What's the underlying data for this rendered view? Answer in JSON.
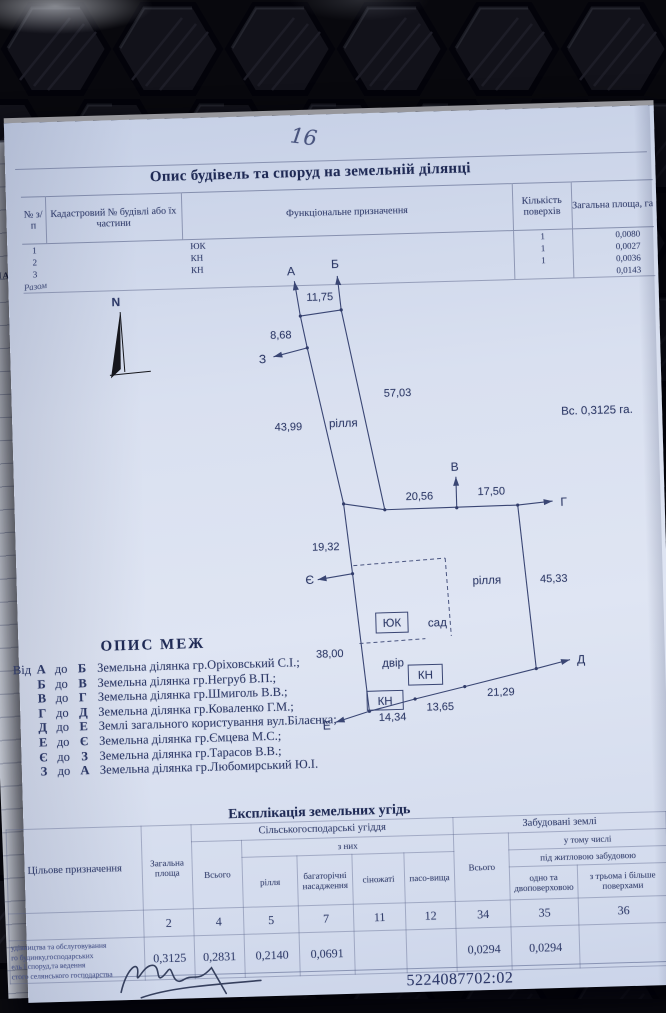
{
  "colors": {
    "page_bg": "#dbe2f1",
    "ink": "#2e3a68",
    "mat": "#0b0b10"
  },
  "photo": {
    "page_number": "16",
    "underpage_text": "ЗНА",
    "underpage_mark": "г"
  },
  "table1": {
    "title": "Опис будівель та споруд на земельній ділянці",
    "headers": {
      "num": "№ з/п",
      "cadastral": "Кадастровий № будівлі або їх частини",
      "function": "Функціональне призначення",
      "floors": "Кількість поверхів",
      "area": "Загальна площа, га"
    },
    "rows": [
      {
        "num": "1",
        "code": "ЮК",
        "floors": "1",
        "area": "0,0080"
      },
      {
        "num": "2",
        "code": "КН",
        "floors": "1",
        "area": "0,0027"
      },
      {
        "num": "3",
        "code": "КН",
        "floors": "1",
        "area": "0,0036"
      },
      {
        "num": "Разом",
        "code": "",
        "floors": "",
        "area": "0,0143"
      }
    ]
  },
  "diagram": {
    "north": "N",
    "area_note": "Вс. 0,3125 га.",
    "pt_a": "А",
    "pt_b": "Б",
    "pt_v": "В",
    "pt_g": "Г",
    "pt_d": "Д",
    "pt_e": "Е",
    "pt_ye": "Є",
    "pt_z": "З",
    "len_ab": "11,75",
    "len_az": "8,68",
    "len_left_slant": "43,99",
    "len_right_slant": "57,03",
    "len_vg1": "20,56",
    "len_vg2": "17,50",
    "len_right_vert": "45,33",
    "len_upper_left_vert": "19,32",
    "len_lower_left_vert": "38,00",
    "len_bottom1": "14,34",
    "len_bottom2": "13,65",
    "len_bottom3": "21,29",
    "land1": "рілля",
    "land2": "рілля",
    "sad": "сад",
    "dvir": "двір",
    "bld_yuk": "ЮК",
    "bld_kn1": "КН",
    "bld_kn2": "КН"
  },
  "borders": {
    "title": "ОПИС МЕЖ",
    "prefix": "Від",
    "connector": "до",
    "rows": [
      {
        "from": "А",
        "to": "Б",
        "text": "Земельна ділянка гр.Оріховський С.І.;"
      },
      {
        "from": "Б",
        "to": "В",
        "text": "Земельна ділянка гр.Негруб В.П.;"
      },
      {
        "from": "В",
        "to": "Г",
        "text": "Земельна ділянка гр.Шмиголь В.В.;"
      },
      {
        "from": "Г",
        "to": "Д",
        "text": "Земельна ділянка гр.Коваленко Г.М.;"
      },
      {
        "from": "Д",
        "to": "Е",
        "text": "Землі загального користування вул.Білаєнка;"
      },
      {
        "from": "Е",
        "to": "Є",
        "text": "Земельна ділянка гр.Ємцева М.С.;"
      },
      {
        "from": "Є",
        "to": "З",
        "text": "Земельна ділянка гр.Тарасов В.В.;"
      },
      {
        "from": "З",
        "to": "А",
        "text": "Земельна ділянка гр.Любомирський Ю.І."
      }
    ]
  },
  "expl": {
    "title": "Експлікація земельних угідь",
    "h_purpose": "Цільове призначення",
    "h_area1": "Загальна",
    "h_area2": "площа",
    "h_agro": "Сільськогосподарські угіддя",
    "h_built": "Забудовані землі",
    "h_total_agro": "Всього",
    "h_of_them": "з них",
    "h_rillia": "рілля",
    "h_perennial": "багаторічні насадження",
    "h_hay": "сіножаті",
    "h_pasture": "пасо-вища",
    "h_total_built": "Всього",
    "h_including": "у тому числі",
    "h_residential": "під житловою забудовою",
    "h_one_two": "одно та двоповерховою",
    "h_three_plus": "з трьома і більше поверхами",
    "col_numbers": [
      "2",
      "4",
      "5",
      "7",
      "11",
      "12",
      "34",
      "35",
      "36"
    ],
    "purpose_lines": [
      "удівництва та обслуговування",
      "го будинку,господарських",
      "ель і споруд,та ведення",
      "стого селянського господарства"
    ],
    "values": [
      "0,3125",
      "0,2831",
      "0,2140",
      "0,0691",
      "",
      "",
      "0,0294",
      "0,0294",
      ""
    ]
  },
  "footer": {
    "cadastral_number": "5224087702:02"
  }
}
